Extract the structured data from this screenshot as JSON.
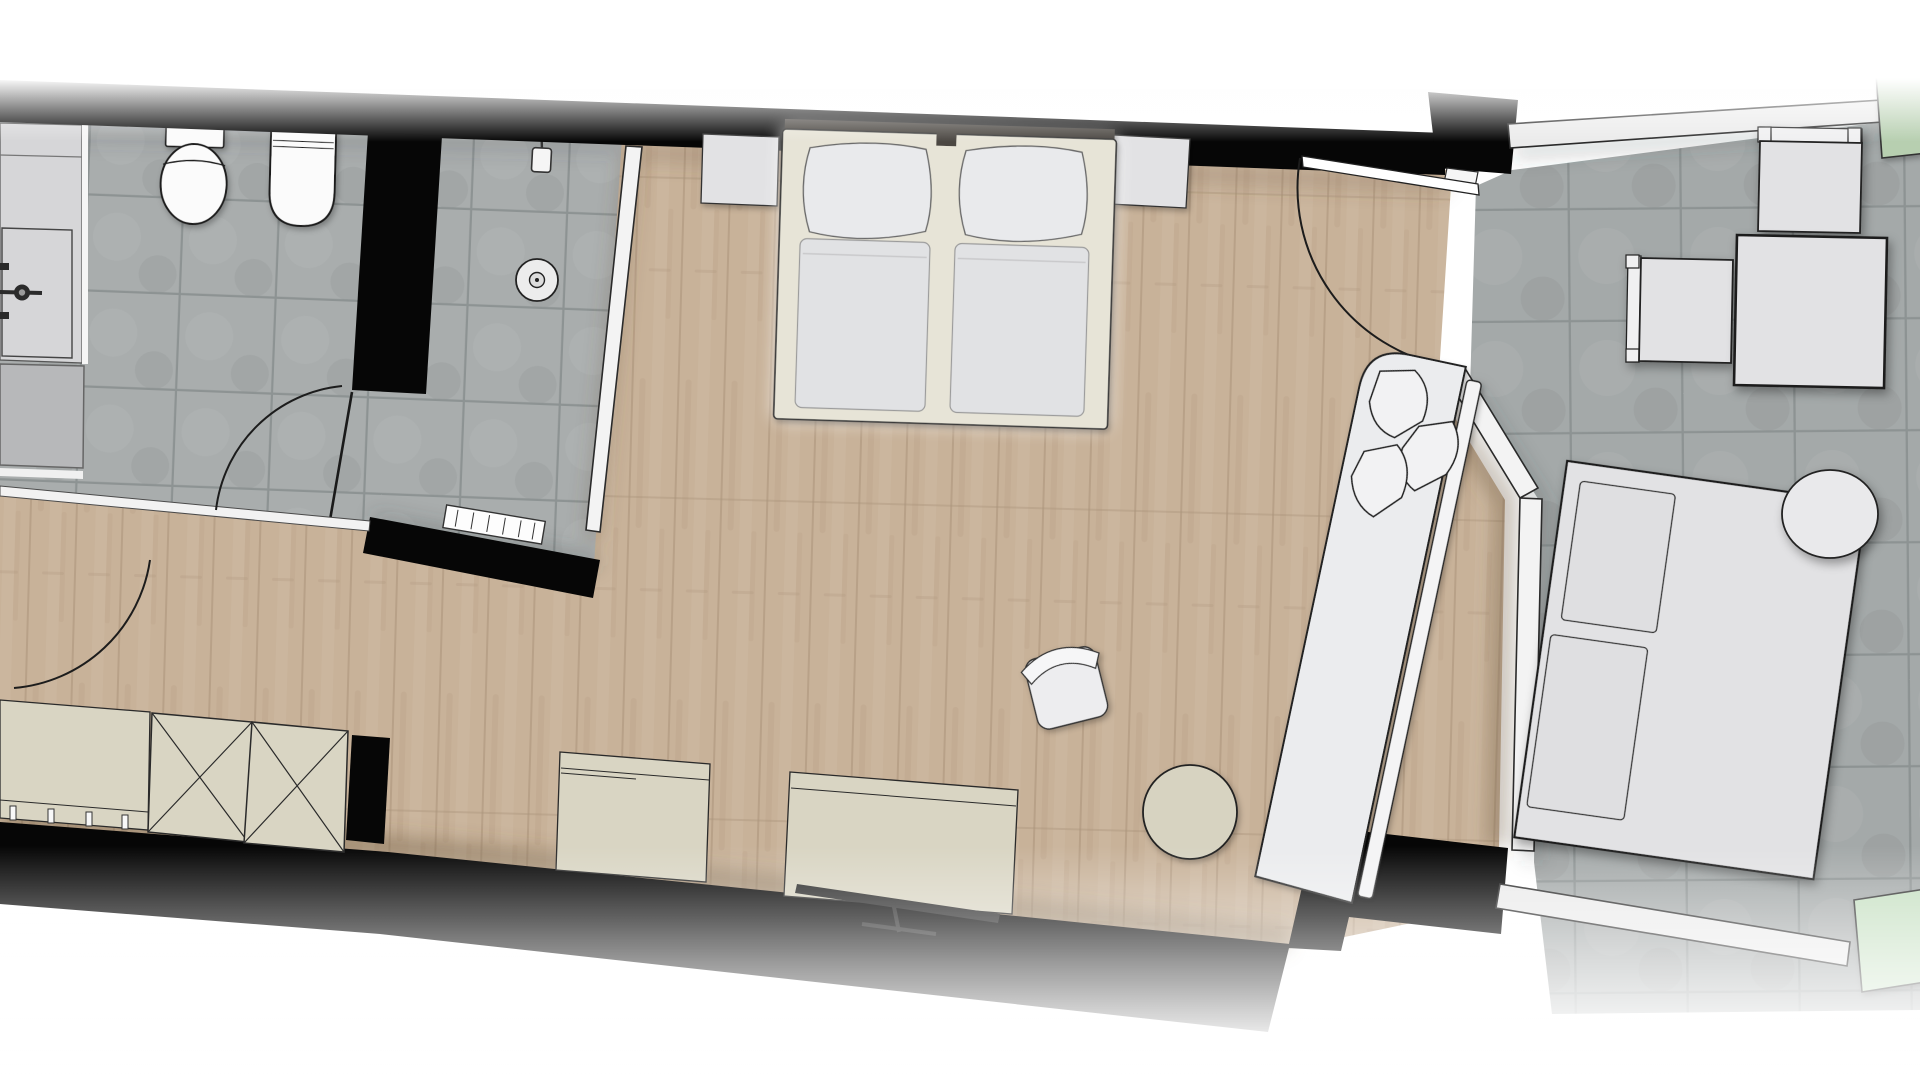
{
  "meta": {
    "kind": "floor-plan",
    "view": "top-down",
    "units": "none"
  },
  "colors": {
    "background": "#ffffff",
    "wall": "#060606",
    "outline": "#1f1f1f",
    "woodBase": "#c8b299",
    "woodLine": "#aa937a",
    "woodShade": "#6b5742",
    "tileBath": "#a9adad",
    "tileBalc": "#a4a9a9",
    "grout": "#8d9393",
    "partition": "#f3f3f3",
    "fixture": "#fbfbfb",
    "vanity": "#d6d6d8",
    "appliance": "#b7b8ba",
    "cream": "#d9d5c3",
    "bedFrame": "#e7e4d7",
    "mattress": "#e1e2e4",
    "pillow": "#e9eaec",
    "headboard": "#4c4742",
    "grayFurn": "#e2e2e4",
    "lounger": "#ebecee",
    "railing": "#ebebeb",
    "greenTop": "#b7cfb0",
    "greenBottom": "#c6e0c2",
    "tv": "#282828",
    "pouf": "#d7d3c1",
    "threshold": "#f2f2f2"
  },
  "rooms": [
    {
      "id": "bathroom",
      "name": "bathroom",
      "floor": "tile"
    },
    {
      "id": "shower",
      "name": "shower",
      "floor": "tile"
    },
    {
      "id": "bedroom",
      "name": "bedroom",
      "floor": "wood"
    },
    {
      "id": "corridor",
      "name": "corridor",
      "floor": "wood"
    },
    {
      "id": "balcony",
      "name": "balcony",
      "floor": "large-tile"
    }
  ],
  "items": [
    {
      "id": "vanity-counter",
      "room": "bathroom"
    },
    {
      "id": "washbasin",
      "room": "bathroom"
    },
    {
      "id": "faucet-symbol",
      "room": "bathroom"
    },
    {
      "id": "appliance-block",
      "room": "bathroom"
    },
    {
      "id": "toilet",
      "room": "bathroom"
    },
    {
      "id": "bidet",
      "room": "bathroom"
    },
    {
      "id": "bathroom-door-swing",
      "room": "bathroom"
    },
    {
      "id": "corridor-door-swing",
      "room": "corridor"
    },
    {
      "id": "shower-head-symbol",
      "room": "shower"
    },
    {
      "id": "floor-drain-symbol",
      "room": "shower"
    },
    {
      "id": "shower-glass-screen",
      "room": "shower"
    },
    {
      "id": "towel-radiator",
      "room": "shower"
    },
    {
      "id": "double-bed",
      "room": "bedroom"
    },
    {
      "id": "pillow-left",
      "room": "bedroom"
    },
    {
      "id": "pillow-right",
      "room": "bedroom"
    },
    {
      "id": "mattress-left",
      "room": "bedroom"
    },
    {
      "id": "mattress-right",
      "room": "bedroom"
    },
    {
      "id": "nightstand-left",
      "room": "bedroom"
    },
    {
      "id": "nightstand-right",
      "room": "bedroom"
    },
    {
      "id": "coat-rack",
      "room": "corridor"
    },
    {
      "id": "wardrobe-left",
      "room": "corridor"
    },
    {
      "id": "wardrobe-right",
      "room": "corridor"
    },
    {
      "id": "sideboard",
      "room": "bedroom"
    },
    {
      "id": "media-desk",
      "room": "bedroom"
    },
    {
      "id": "tv-flatscreen",
      "room": "bedroom"
    },
    {
      "id": "desk-chair",
      "room": "bedroom"
    },
    {
      "id": "pouf",
      "room": "bedroom"
    },
    {
      "id": "daybed-lounger",
      "room": "bedroom"
    },
    {
      "id": "lounger-leaf-pillows",
      "room": "bedroom"
    },
    {
      "id": "entry-door-swing",
      "room": "bedroom"
    },
    {
      "id": "balcony-railing",
      "room": "balcony"
    },
    {
      "id": "planter-upper",
      "room": "balcony"
    },
    {
      "id": "planter-lower",
      "room": "balcony"
    },
    {
      "id": "outdoor-chair-upper",
      "room": "balcony"
    },
    {
      "id": "outdoor-chair-side",
      "room": "balcony"
    },
    {
      "id": "outdoor-table",
      "room": "balcony"
    },
    {
      "id": "sun-lounger",
      "room": "balcony"
    },
    {
      "id": "sun-lounger-cushion-1",
      "room": "balcony"
    },
    {
      "id": "sun-lounger-cushion-2",
      "room": "balcony"
    },
    {
      "id": "round-side-table",
      "room": "balcony"
    }
  ]
}
